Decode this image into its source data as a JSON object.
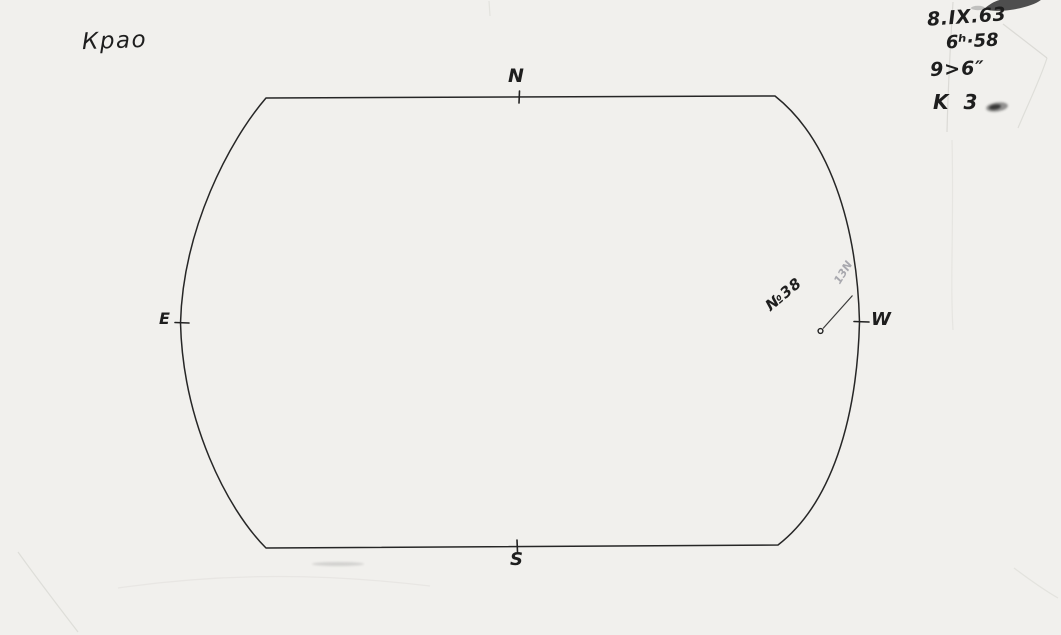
{
  "corner_label": {
    "text": "Крао"
  },
  "observation_notes": {
    "date": "8.IX.63",
    "time": "6ʰ·58",
    "seeing": "9>6″",
    "quality": "K 3"
  },
  "compass": {
    "north": "N",
    "south": "S",
    "east": "E",
    "west": "W"
  },
  "sunspot": {
    "group_label": "№38",
    "pencil_note": "13N"
  },
  "colors": {
    "paper": "#f3f2ef",
    "ink": "#1e1e1e",
    "pencil": "#97979f",
    "crease": "#d6d5d0"
  }
}
